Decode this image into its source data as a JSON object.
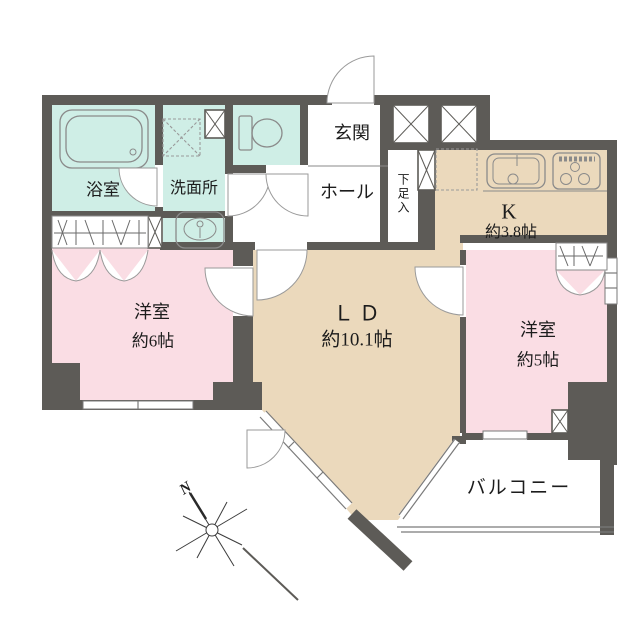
{
  "title": "floor-plan",
  "labels": {
    "bath": "浴室",
    "washroom": "洗面所",
    "entrance": "玄関",
    "hall": "ホール",
    "shoe_storage": "下足入",
    "kitchen": "K",
    "kitchen_size": "約3.8帖",
    "bedroom_left": "洋室",
    "bedroom_left_size": "約6帖",
    "living_dining": "ＬＤ",
    "living_dining_size": "約10.1帖",
    "bedroom_right": "洋室",
    "bedroom_right_size": "約5帖",
    "balcony": "バルコニー",
    "north": "N"
  },
  "colors": {
    "wall": "#5d5b57",
    "wet_area": "#cfeee6",
    "bedroom": "#fadde4",
    "living": "#ebd9bc",
    "outline": "#7a7a7a",
    "background": "#ffffff"
  }
}
